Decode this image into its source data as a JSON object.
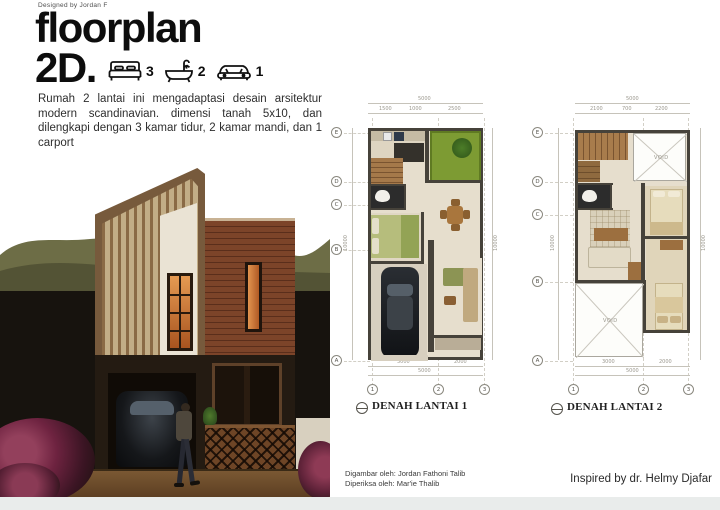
{
  "header": {
    "designed_by": "Designed by Jordan F",
    "title_line1": "floorplan",
    "title_line2": "2D.",
    "stats": [
      {
        "icon": "bed-icon",
        "count": "3"
      },
      {
        "icon": "bath-icon",
        "count": "2"
      },
      {
        "icon": "car-icon",
        "count": "1"
      }
    ]
  },
  "description": "Rumah 2 lantai ini mengadaptasi desain arsitektur modern scandinavian. dimensi tanah 5x10, dan dilengkapi dengan 3 kamar tidur, 2 kamar mandi, dan 1 carport",
  "plans": [
    {
      "title": "DENAH LANTAI 1",
      "grid_cols": [
        "1",
        "2",
        "3"
      ],
      "grid_rows": [
        "E",
        "D",
        "C",
        "B",
        "A"
      ],
      "dims": {
        "top_total": "5000",
        "top_segments": [
          "1500",
          "1000",
          "2500"
        ],
        "bottom_segments": [
          "3000",
          "2000"
        ],
        "bottom_total": "5000",
        "left_total": "10000",
        "right_total": "10000"
      }
    },
    {
      "title": "DENAH LANTAI 2",
      "void_label": "VOID",
      "grid_cols": [
        "1",
        "2",
        "3"
      ],
      "grid_rows": [
        "E",
        "D",
        "C",
        "B",
        "A"
      ],
      "dims": {
        "top_total": "5000",
        "top_segments": [
          "2100",
          "700",
          "2200"
        ],
        "bottom_segments": [
          "3000",
          "2000"
        ],
        "bottom_total": "5000",
        "left_total": "10000",
        "right_total": "10000"
      }
    }
  ],
  "credits": {
    "drawn_by": "Digambar oleh: Jordan Fathoni Talib",
    "checked_by": "Diperiksa oleh: Mar'ie Thalib",
    "inspired_by": "Inspired by dr. Helmy Djafar"
  },
  "colors": {
    "title_text": "#0d0d0d",
    "plan_wall": "#46423a",
    "plan_floor": "#e6decd",
    "garden_green": "#7d9b33",
    "bed_green": "#b6bd7c",
    "wood": "#a87c4c",
    "render_dark": "#17130e",
    "ground_brown": "#6a4b29",
    "bottom_strip": "#e9eceb"
  }
}
